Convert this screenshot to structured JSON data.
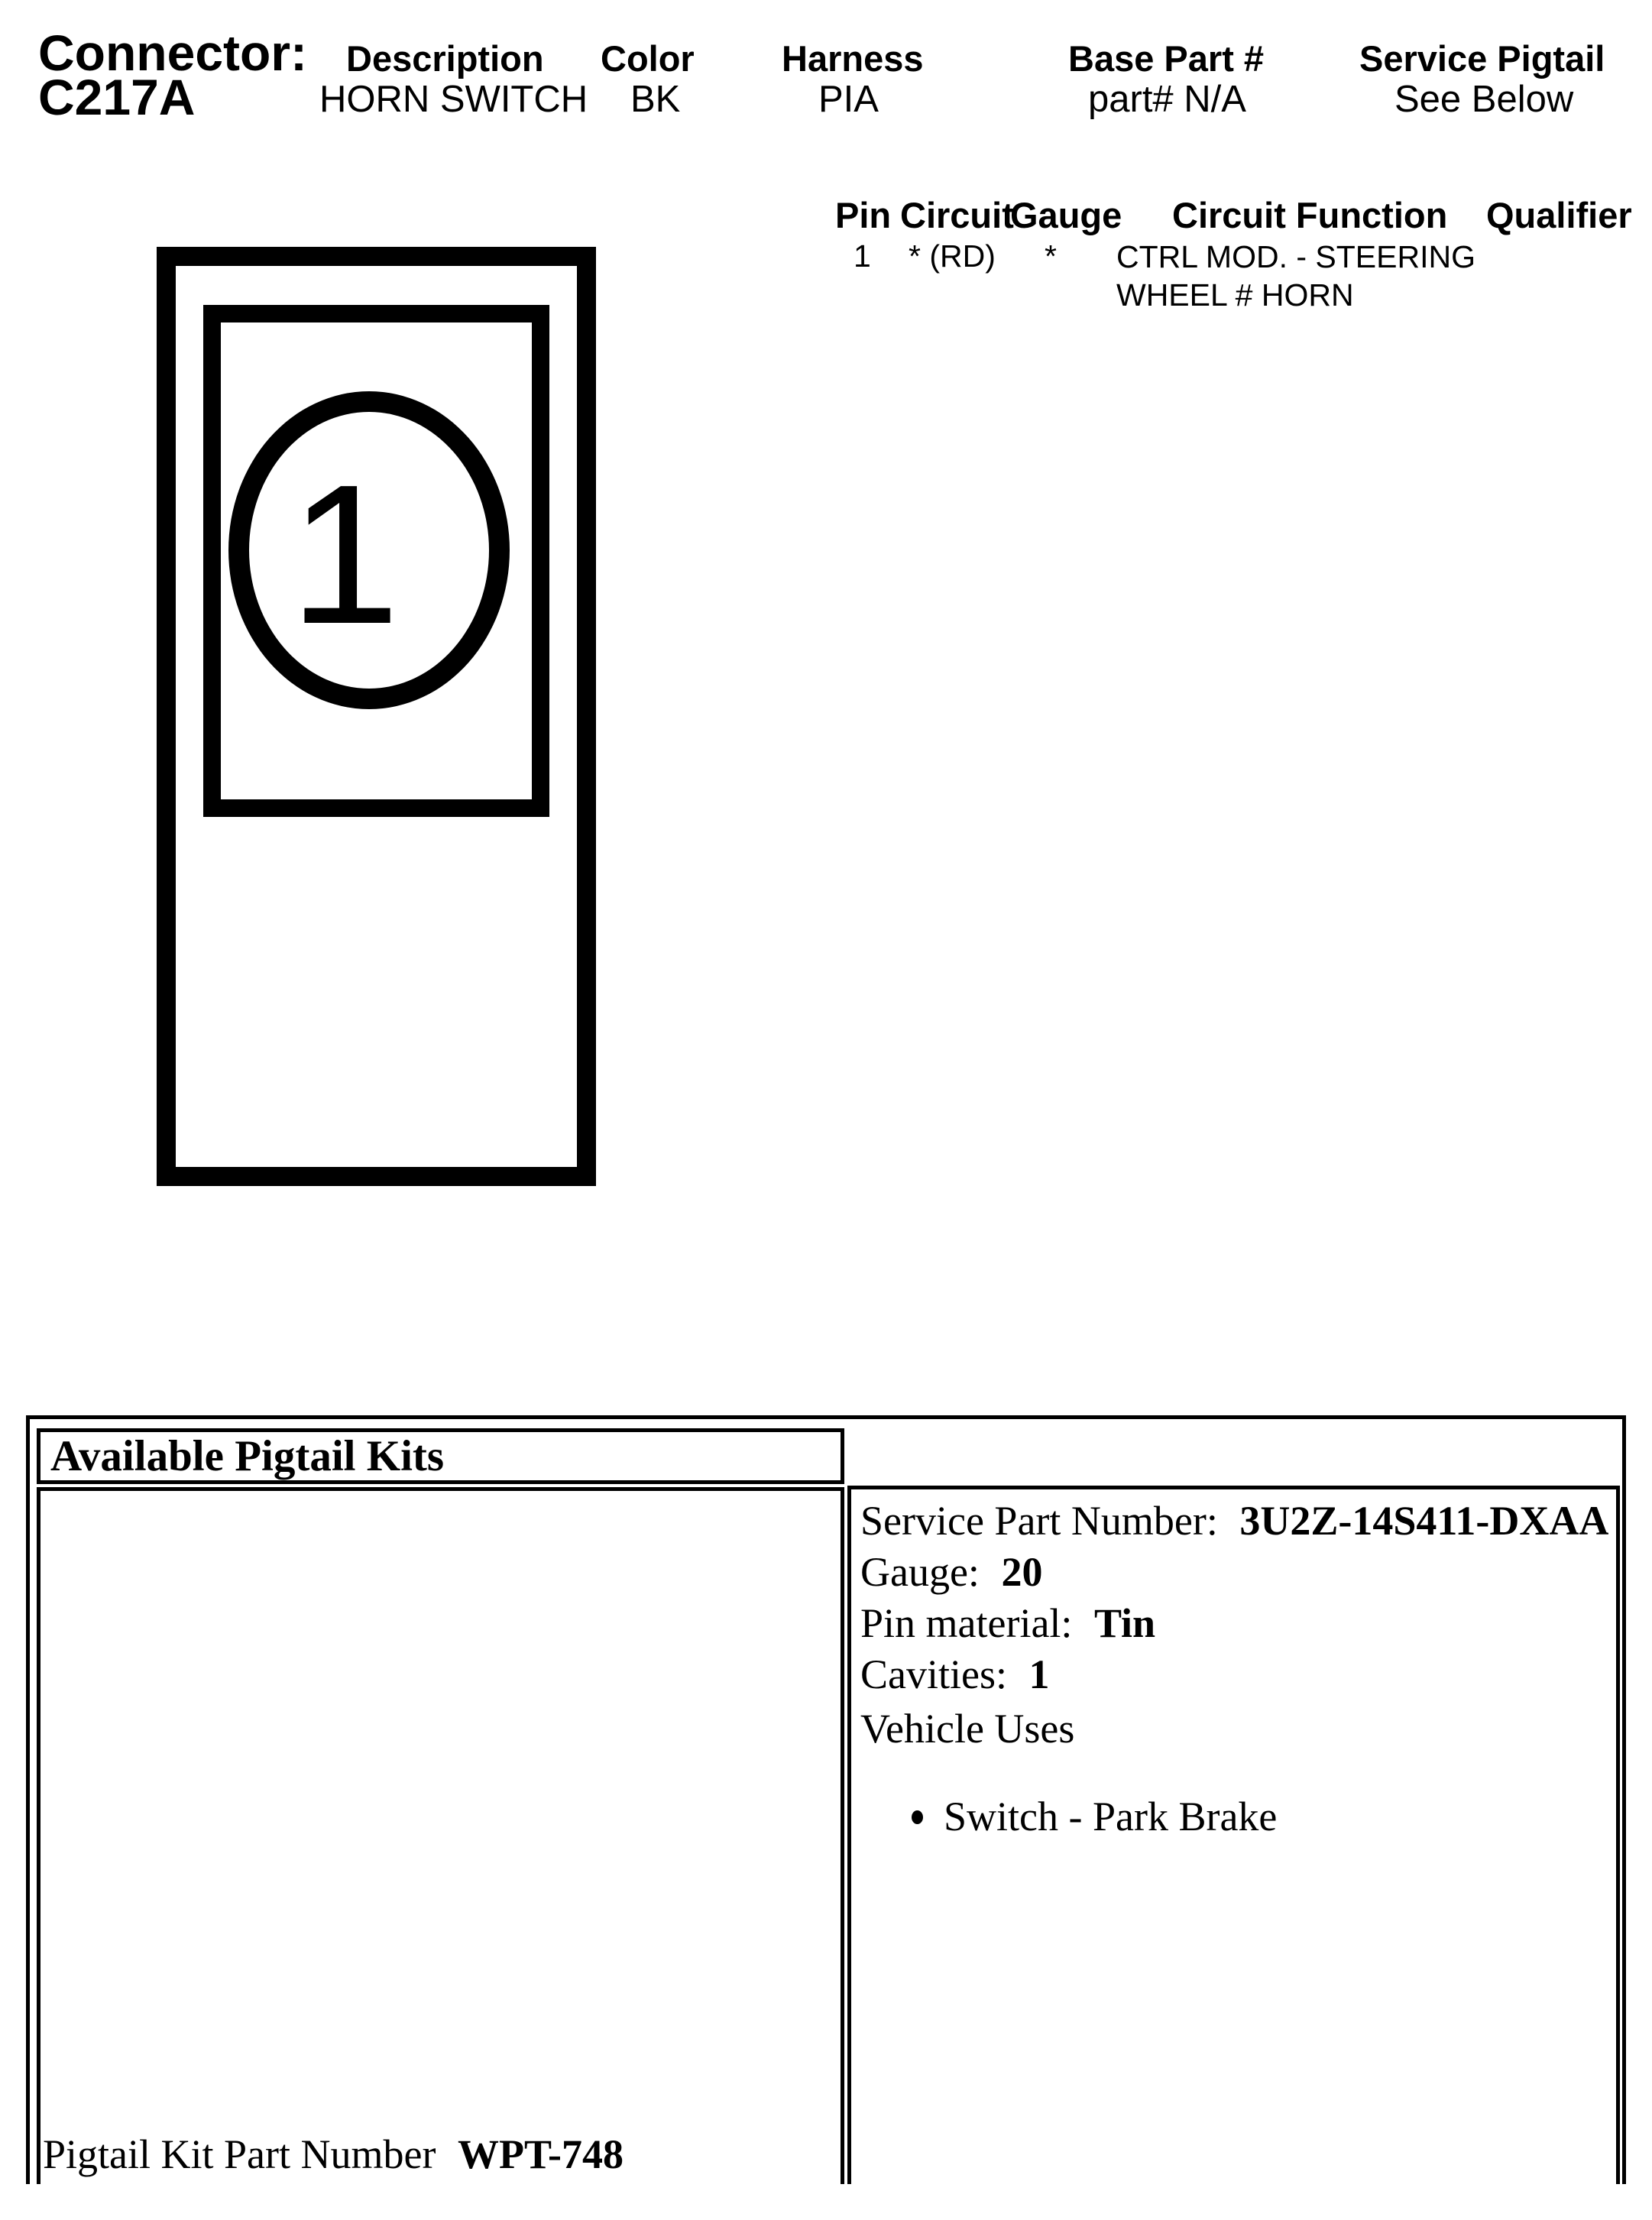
{
  "colors": {
    "ink": "#000000",
    "paper": "#ffffff"
  },
  "header": {
    "connector_label": "Connector:",
    "connector_id": "C217A",
    "fields": [
      {
        "label": "Description",
        "value": "HORN SWITCH"
      },
      {
        "label": "Color",
        "value": "BK"
      },
      {
        "label": "Harness",
        "value": "PIA"
      },
      {
        "label": "Base Part #",
        "value": "part# N/A"
      },
      {
        "label": "Service Pigtail",
        "value": "See Below"
      }
    ]
  },
  "pin_table": {
    "headers": {
      "pin": "Pin",
      "circuit": "Circuit",
      "gauge": "Gauge",
      "function": "Circuit Function",
      "qualifier": "Qualifier"
    },
    "rows": [
      {
        "pin": "1",
        "circuit": "* (RD)",
        "gauge": "*",
        "function_line1": "CTRL MOD. - STEERING",
        "function_line2": "WHEEL # HORN",
        "qualifier": ""
      }
    ]
  },
  "diagram": {
    "cavity_label": "1"
  },
  "pigtail": {
    "title": "Available Pigtail Kits",
    "kit_label": "Pigtail Kit Part Number",
    "kit_number": "WPT-748",
    "service": {
      "part_label": "Service Part Number:",
      "part_number": "3U2Z-14S411-DXAA",
      "gauge_label": "Gauge:",
      "gauge": "20",
      "pin_material_label": "Pin material:",
      "pin_material": "Tin",
      "cavities_label": "Cavities:",
      "cavities": "1",
      "vehicle_uses_label": "Vehicle Uses",
      "uses": [
        "Switch - Park Brake"
      ]
    }
  }
}
